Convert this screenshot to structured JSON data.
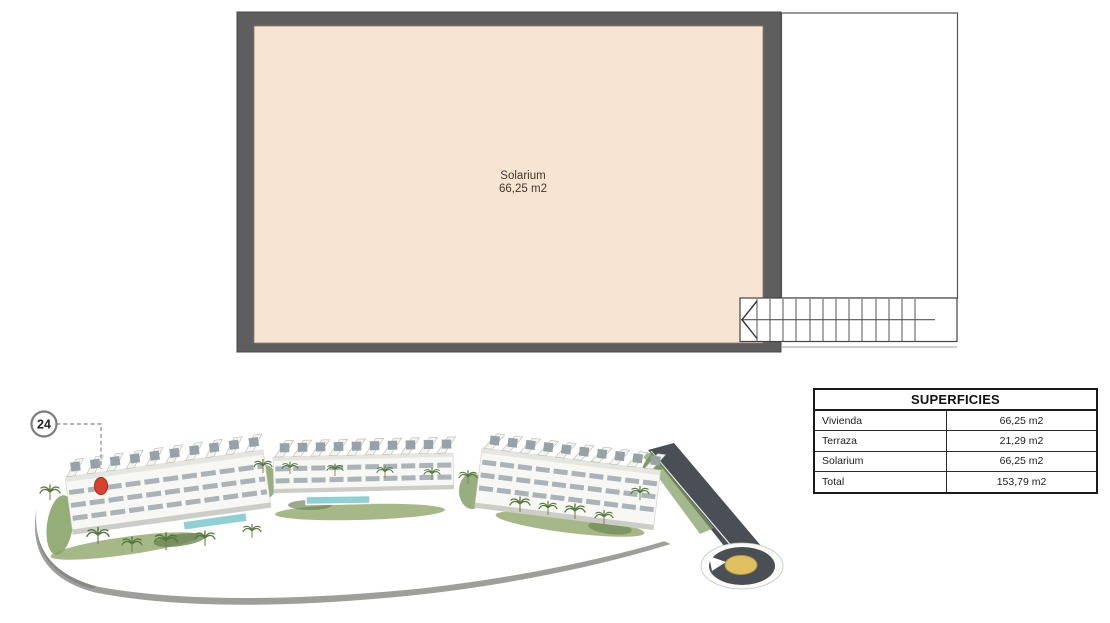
{
  "floor_plan": {
    "room": {
      "label": "Solarium",
      "area": "66,25 m2"
    },
    "colors": {
      "wall": "#5e5e5e",
      "floor": "#f7e4d1"
    }
  },
  "callout": {
    "unit_number": "24"
  },
  "superficies_table": {
    "title": "SUPERFICIES",
    "rows": [
      {
        "label": "Vivienda",
        "value": "66,25 m2"
      },
      {
        "label": "Terraza",
        "value": "21,29 m2"
      },
      {
        "label": "Solarium",
        "value": "66,25 m2"
      },
      {
        "label": "Total",
        "value": "153,79 m2"
      }
    ]
  }
}
